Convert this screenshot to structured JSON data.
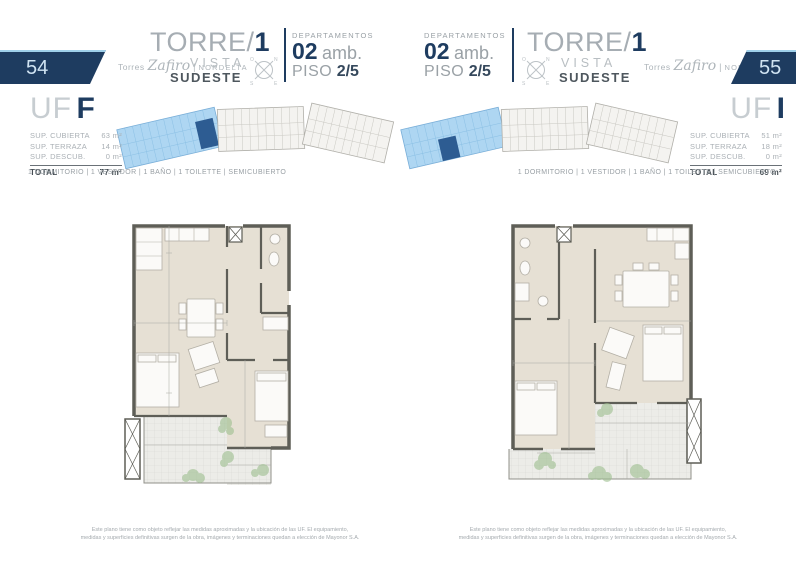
{
  "brand": {
    "prefix": "Torres",
    "script": "Zafiro",
    "separator": "|",
    "suffix": "NORDELTA"
  },
  "compass": {
    "n": "N",
    "e": "E",
    "s": "S",
    "o": "O"
  },
  "colors": {
    "navy": "#1e3c60",
    "tower_blue": "#aed6f2",
    "unit_highlight": "#2d5c92",
    "plan_beige": "#e6e0d4"
  },
  "pages": {
    "left": {
      "page_number": "54",
      "title": {
        "torre_prefix": "TORRE/",
        "torre_number": "1",
        "vista": "VISTA",
        "direction": "SUDESTE"
      },
      "department": {
        "label": "DEPARTAMENTOS",
        "amb_value": "02",
        "amb_unit": "amb.",
        "piso_label": "PISO",
        "piso_value": "2/5"
      },
      "unit": {
        "uf_label": "UF",
        "uf_letter": "F",
        "surfaces": [
          {
            "label": "SUP. CUBIERTA",
            "value": "63 m²"
          },
          {
            "label": "SUP. TERRAZA",
            "value": "14 m²"
          },
          {
            "label": "SUP. DESCUB.",
            "value": "0 m²"
          }
        ],
        "total_label": "TOTAL",
        "total_value": "77 m²"
      },
      "features": "1 DORMITORIO | 1 VESTIDOR | 1 BAÑO | 1 TOILETTE | SEMICUBIERTO",
      "disclaimer_line1": "Este plano tiene como objeto reflejar las medidas aproximadas y la ubicación de las UF. El equipamiento,",
      "disclaimer_line2": "medidas y superficies definitivas surgen de la obra, imágenes y terminaciones quedan a elección de Mayonor S.A."
    },
    "right": {
      "page_number": "55",
      "title": {
        "torre_prefix": "TORRE/",
        "torre_number": "1",
        "vista": "VISTA",
        "direction": "SUDESTE"
      },
      "department": {
        "label": "DEPARTAMENTOS",
        "amb_value": "02",
        "amb_unit": "amb.",
        "piso_label": "PISO",
        "piso_value": "2/5"
      },
      "unit": {
        "uf_label": "UF",
        "uf_letter": "I",
        "surfaces": [
          {
            "label": "SUP. CUBIERTA",
            "value": "51 m²"
          },
          {
            "label": "SUP. TERRAZA",
            "value": "18 m²"
          },
          {
            "label": "SUP. DESCUB.",
            "value": "0 m²"
          }
        ],
        "total_label": "TOTAL",
        "total_value": "69 m²"
      },
      "features": "1 DORMITORIO | 1 VESTIDOR | 1 BAÑO | 1 TOILETTE | SEMICUBIERTO",
      "disclaimer_line1": "Este plano tiene como objeto reflejar las medidas aproximadas y la ubicación de las UF. El equipamiento,",
      "disclaimer_line2": "medidas y superficies definitivas surgen de la obra, imágenes y terminaciones quedan a elección de Mayonor S.A."
    }
  }
}
